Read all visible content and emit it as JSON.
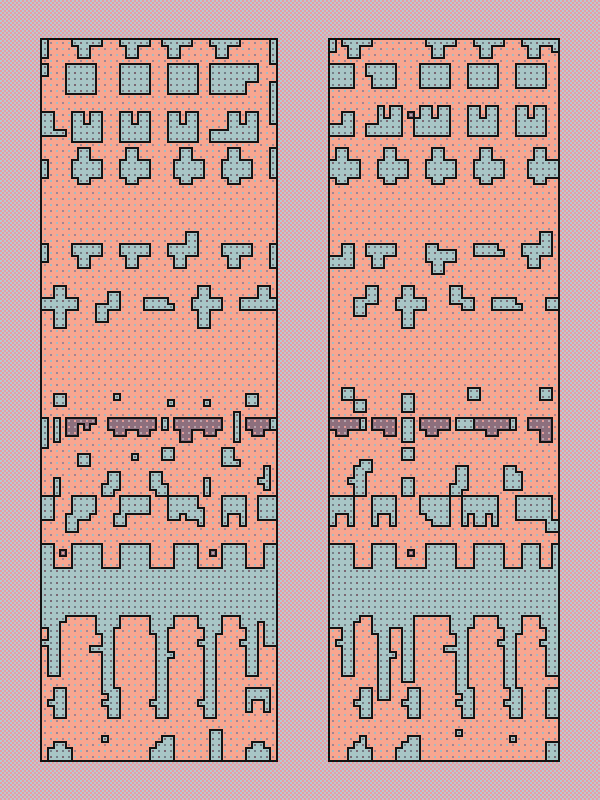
{
  "scene": {
    "width": 600,
    "height": 800
  },
  "background": {
    "checker_colors": [
      "#eb9aa3",
      "#b6cbd1"
    ],
    "checker_px": 2
  },
  "palette": {
    "salmon": "#f8a690",
    "blue": "#a8c6c6",
    "mauve": "#8d6f7d",
    "outline": "#141414",
    "dot_on_salmon": [
      "#a2bcc4",
      "#a08693"
    ],
    "dot_on_blue": [
      "#7b6773",
      "#748089"
    ],
    "dot_on_mauve": [
      "#e49c98",
      "#b5a3ad"
    ]
  },
  "grid": {
    "cell_px": 6,
    "rows": 120,
    "border_px": 2,
    "dot_px": 2,
    "dot_offset": 2
  },
  "shapes": {
    "tab": [
      "bbbbb",
      ".bb..",
      ".bb.."
    ],
    "tabF": [
      "bbbbb",
      "bbbbb",
      ".bb..",
      ".bb.."
    ],
    "tabFlag": [
      "...bb",
      "...bb",
      "bbbbb",
      "bbbbb",
      ".bb..",
      ".bb.."
    ],
    "tabFlagL": [
      "bb...",
      "bbbbb",
      "bbbbb",
      ".bb..",
      ".bb.."
    ],
    "flagL": [
      "..bb",
      "..bb",
      "bbbb",
      "bbbb"
    ],
    "rect55": [
      "bbbbb",
      "bbbbb",
      "bbbbb",
      "bbbbb",
      "bbbbb"
    ],
    "rectNotch": [
      "bbbbbbbb",
      "bbbbbbbb",
      "bbbbbbbb",
      "bbbbbb..",
      "bbbbbb.."
    ],
    "rectNBL": [
      "bbbbb",
      "bbbbb",
      ".bbbb",
      ".bbbb"
    ],
    "rectNBLtall": [
      "bbbbb",
      "bbbbb",
      "bbbbb",
      ".bbbb",
      "..bbb"
    ],
    "cup": [
      "bb.bb",
      "bb.bb",
      "bbbbb",
      "bbbbb",
      "bbbbb"
    ],
    "cupFoot": [
      "...bb.bb",
      "...bb.bb",
      "...bbbbb",
      "bbbbbbbb",
      "bbbbbbbb"
    ],
    "cupFootL": [
      "..b.bb",
      "..b.bb",
      "..bbbb",
      "bbbbbb",
      "bbbbbb"
    ],
    "edgeL": [
      "bb..",
      "bb..",
      "bb..",
      "bbbb"
    ],
    "cross": [
      ".bb..",
      ".bb..",
      "bbbbb",
      "bbbbb",
      "bbbbb",
      ".bb.."
    ],
    "plusTall": [
      ".bb..",
      ".bb..",
      "bbbbb",
      "bbbbb",
      ".bb..",
      ".bb..",
      ".bb.."
    ],
    "hook4": [
      "..bb",
      "..bb",
      "bbbb",
      "bb..",
      "bb.."
    ],
    "hook4R": [
      "bb..",
      "bb..",
      "bbbb",
      "..bb"
    ],
    "barStep": [
      "bbbb.",
      "bbbbb"
    ],
    "barFlagR": [
      "...bb",
      "...bb",
      "bbbbb",
      "bbbbb"
    ],
    "bootL4": [
      ".bb",
      ".bb",
      "bbb",
      "bb."
    ],
    "bootR4": [
      "bb.",
      "bb.",
      "bbb",
      ".bb"
    ],
    "boot3": [
      "bb.",
      "bb.",
      "bbb"
    ],
    "tleft": [
      ".b",
      ".b",
      "bb",
      ".b"
    ],
    "blobH": [
      ".bbbb",
      ".bbbb",
      ".bbbb",
      "bbbb.",
      "bb...",
      "bb..."
    ],
    "blobM": [
      "bbbbb",
      "bbbbb",
      "bbbbb",
      "bb.bb"
    ],
    "arch": [
      "bbbb",
      "bbbb",
      "bbbb",
      "b..b",
      "b..b"
    ],
    "arch4": [
      "bbbb",
      "bbbb",
      "b..b",
      "b..b"
    ],
    "arch2": [
      "bbbbbb",
      "bbbbbb",
      "bbbbbb",
      "b.bb.b",
      "b.bb.b"
    ],
    "midA": [
      ".bb",
      ".bb",
      "bbb",
      ".bb",
      ".bb"
    ],
    "dripB": [
      "bbbb",
      "bbb.",
      ".bb.",
      ".bb.",
      "bbb.",
      ".bb.",
      ".bb.",
      ".bb.",
      ".bb.",
      ".bb."
    ],
    "dripC": [
      ".bbbb",
      ".bbbb",
      ".bbb.",
      "..bb.",
      "..bb.",
      "bbbb.",
      "..bb.",
      "..bb.",
      "..bb.",
      "..bb.",
      "..bb.",
      "..bb.",
      "..bb."
    ],
    "dripD": [
      "bbbb",
      "bbbb",
      "bbb.",
      ".bb.",
      ".bb.",
      ".bb.",
      ".bbb",
      ".bb.",
      ".bb.",
      ".bb.",
      ".bb.",
      ".bb.",
      ".bb.",
      ".bb."
    ],
    "dripE": [
      "bbbb",
      "bbbb",
      ".bbb",
      ".bb.",
      "bbb.",
      ".bb.",
      ".bb.",
      ".bb.",
      ".bb.",
      ".bb.",
      ".bb.",
      ".bb."
    ],
    "bot": [
      ".bb.",
      "bbbb",
      "bbbb"
    ],
    "botTall": [
      "..bb",
      ".bbb",
      "bbbb",
      "bbbb"
    ],
    "mA": [
      "ppppp",
      "pp.p.",
      "pp..."
    ],
    "mtable": [
      "pppppppp",
      "pppppppp",
      ".pp..pp."
    ],
    "mtableB": [
      "pppppppp",
      "pppppppp",
      ".pp..pp.",
      ".pp....."
    ],
    "mtableR": [
      "pppp",
      "pppp",
      ".pp."
    ],
    "m5": [
      "ppppp",
      "ppppp",
      ".pp.."
    ],
    "mt4": [
      "pppp",
      "pppp",
      "..pp"
    ],
    "mt4L": [
      "pppp",
      "pppp",
      "..pp",
      "..pp"
    ],
    "mLong": [
      "pppppp",
      "pppppp",
      "..pp.."
    ],
    "msq": [
      "p"
    ],
    "sq1": [
      "b"
    ],
    "sq2": [
      "bb",
      "bb"
    ]
  },
  "panels": [
    {
      "name": "left-pattern-panel",
      "x": 40,
      "y": 38,
      "cols": 39,
      "placements": [
        [
          "#",
          0,
          0,
          1,
          3,
          "b"
        ],
        [
          "tab",
          5,
          0
        ],
        [
          "tab",
          13,
          0
        ],
        [
          "tab",
          20,
          0
        ],
        [
          "tab",
          28,
          0
        ],
        [
          "#",
          38,
          0,
          1,
          4,
          "b"
        ],
        [
          "#",
          0,
          4,
          1,
          2,
          "b"
        ],
        [
          "rect55",
          4,
          4
        ],
        [
          "rect55",
          13,
          4
        ],
        [
          "rect55",
          21,
          4
        ],
        [
          "rectNotch",
          28,
          4
        ],
        [
          "#",
          38,
          7,
          1,
          4,
          "b"
        ],
        [
          "edgeL",
          0,
          12
        ],
        [
          "cup",
          5,
          12
        ],
        [
          "cup",
          13,
          12
        ],
        [
          "cup",
          21,
          12
        ],
        [
          "cupFoot",
          28,
          12
        ],
        [
          "#",
          38,
          11,
          1,
          3,
          "b"
        ],
        [
          "#",
          0,
          20,
          1,
          3,
          "b"
        ],
        [
          "cross",
          5,
          18
        ],
        [
          "cross",
          13,
          18
        ],
        [
          "cross",
          22,
          18
        ],
        [
          "cross",
          30,
          18
        ],
        [
          "#",
          38,
          18,
          1,
          5,
          "b"
        ],
        [
          "#",
          0,
          34,
          1,
          3,
          "b"
        ],
        [
          "tabF",
          5,
          34
        ],
        [
          "tabF",
          13,
          34
        ],
        [
          "tabFlag",
          21,
          32
        ],
        [
          "tabF",
          30,
          34
        ],
        [
          "#",
          38,
          34,
          1,
          4,
          "b"
        ],
        [
          "plusTall",
          1,
          41
        ],
        [
          "#",
          0,
          43,
          1,
          2,
          "b"
        ],
        [
          "hook4",
          9,
          42
        ],
        [
          "barStep",
          17,
          43
        ],
        [
          "plusTall",
          25,
          41
        ],
        [
          "barFlagR",
          33,
          41
        ],
        [
          "#",
          38,
          43,
          1,
          2,
          "b"
        ],
        [
          "sq2",
          2,
          59
        ],
        [
          "sq1",
          12,
          59
        ],
        [
          "sq1",
          21,
          60
        ],
        [
          "sq1",
          27,
          60
        ],
        [
          "sq2",
          34,
          59
        ],
        [
          "#",
          0,
          63,
          1,
          5,
          "b"
        ],
        [
          "#",
          2,
          63,
          1,
          4,
          "b"
        ],
        [
          "mA",
          4,
          63
        ],
        [
          "mtable",
          11,
          63
        ],
        [
          "#",
          20,
          63,
          1,
          2,
          "b"
        ],
        [
          "mtableB",
          22,
          63
        ],
        [
          "#",
          32,
          62,
          1,
          5,
          "b"
        ],
        [
          "mtableR",
          34,
          63
        ],
        [
          "#",
          38,
          63,
          1,
          2,
          "b"
        ],
        [
          "sq2",
          6,
          69
        ],
        [
          "sq1",
          15,
          69
        ],
        [
          "sq2",
          20,
          68
        ],
        [
          "boot3",
          30,
          68
        ],
        [
          "#",
          2,
          73,
          1,
          3,
          "b"
        ],
        [
          "bootL4",
          10,
          72
        ],
        [
          "bootR4",
          18,
          72
        ],
        [
          "#",
          27,
          73,
          1,
          3,
          "b"
        ],
        [
          "tleft",
          36,
          71
        ],
        [
          "#",
          0,
          76,
          2,
          4,
          "b"
        ],
        [
          "blobH",
          4,
          76
        ],
        [
          "sq2",
          12,
          79
        ],
        [
          "#",
          13,
          76,
          5,
          3,
          "b"
        ],
        [
          "blobM",
          21,
          76
        ],
        [
          "#",
          26,
          78,
          1,
          3,
          "b"
        ],
        [
          "arch",
          30,
          76
        ],
        [
          "#",
          36,
          76,
          3,
          4,
          "b"
        ],
        [
          "#",
          0,
          84,
          2,
          4,
          "b"
        ],
        [
          "msq",
          3,
          85
        ],
        [
          "#",
          5,
          84,
          5,
          4,
          "b"
        ],
        [
          "#",
          13,
          84,
          5,
          4,
          "b"
        ],
        [
          "#",
          22,
          84,
          4,
          4,
          "b"
        ],
        [
          "msq",
          28,
          85
        ],
        [
          "#",
          30,
          84,
          4,
          4,
          "b"
        ],
        [
          "#",
          37,
          84,
          2,
          4,
          "b"
        ],
        [
          "#",
          0,
          88,
          39,
          8,
          "b"
        ],
        [
          "dripB",
          0,
          96
        ],
        [
          "dripC",
          8,
          96
        ],
        [
          "dripD",
          18,
          96
        ],
        [
          "dripE",
          26,
          96
        ],
        [
          "dripB",
          33,
          96
        ],
        [
          "#",
          37,
          96,
          2,
          5,
          "b"
        ],
        [
          "midA",
          1,
          108
        ],
        [
          "midA",
          10,
          108
        ],
        [
          "midA",
          18,
          108
        ],
        [
          "midA",
          26,
          108
        ],
        [
          "arch4",
          34,
          108
        ],
        [
          "sq1",
          10,
          116
        ],
        [
          "sq1",
          20,
          116
        ],
        [
          "#",
          28,
          115,
          2,
          5,
          "b"
        ],
        [
          "bot",
          1,
          117
        ],
        [
          "botTall",
          18,
          116
        ],
        [
          "bot",
          34,
          117
        ]
      ]
    },
    {
      "name": "right-pattern-panel",
      "x": 328,
      "y": 38,
      "cols": 38,
      "placements": [
        [
          "#",
          0,
          0,
          1,
          2,
          "b"
        ],
        [
          "tab",
          2,
          0
        ],
        [
          "tab",
          16,
          0
        ],
        [
          "tab",
          24,
          0
        ],
        [
          "tab",
          32,
          0
        ],
        [
          "#",
          37,
          0,
          1,
          2,
          "b"
        ],
        [
          "#",
          0,
          4,
          4,
          4,
          "b"
        ],
        [
          "rectNBL",
          6,
          4
        ],
        [
          "#",
          15,
          4,
          5,
          4,
          "b"
        ],
        [
          "#",
          23,
          4,
          5,
          4,
          "b"
        ],
        [
          "#",
          31,
          4,
          5,
          4,
          "b"
        ],
        [
          "flagL",
          0,
          12
        ],
        [
          "cupFootL",
          6,
          11
        ],
        [
          "msq",
          13,
          12
        ],
        [
          "#",
          14,
          13,
          1,
          3,
          "b"
        ],
        [
          "cup",
          15,
          11
        ],
        [
          "cup",
          23,
          11
        ],
        [
          "cup",
          31,
          11
        ],
        [
          "cross",
          0,
          18
        ],
        [
          "cross",
          8,
          18
        ],
        [
          "cross",
          16,
          18
        ],
        [
          "cross",
          24,
          18
        ],
        [
          "cross",
          33,
          18
        ],
        [
          "flagL",
          0,
          34
        ],
        [
          "tabF",
          6,
          34
        ],
        [
          "tabFlagL",
          16,
          34
        ],
        [
          "barStep",
          24,
          34
        ],
        [
          "tabFlag",
          32,
          32
        ],
        [
          "hook4",
          4,
          41
        ],
        [
          "plusTall",
          11,
          41
        ],
        [
          "hook4R",
          20,
          41
        ],
        [
          "barStep",
          27,
          43
        ],
        [
          "#",
          36,
          43,
          2,
          2,
          "b"
        ],
        [
          "sq2",
          2,
          58
        ],
        [
          "sq2",
          4,
          60
        ],
        [
          "#",
          12,
          59,
          2,
          3,
          "b"
        ],
        [
          "sq2",
          23,
          58
        ],
        [
          "sq2",
          35,
          58
        ],
        [
          "m5",
          0,
          63
        ],
        [
          "#",
          5,
          63,
          1,
          2,
          "b"
        ],
        [
          "mt4",
          7,
          63
        ],
        [
          "#",
          12,
          63,
          2,
          4,
          "b"
        ],
        [
          "m5",
          15,
          63
        ],
        [
          "#",
          21,
          63,
          3,
          2,
          "b"
        ],
        [
          "mLong",
          24,
          63
        ],
        [
          "#",
          30,
          63,
          1,
          2,
          "b"
        ],
        [
          "mt4L",
          33,
          63
        ],
        [
          "sq2",
          12,
          68
        ],
        [
          "#",
          5,
          70,
          2,
          2,
          "b"
        ],
        [
          "#",
          21,
          71,
          2,
          1,
          "b"
        ],
        [
          "#",
          29,
          71,
          2,
          1,
          "b"
        ],
        [
          "midA",
          3,
          71
        ],
        [
          "#",
          12,
          73,
          2,
          3,
          "b"
        ],
        [
          "bootL4",
          20,
          72
        ],
        [
          "#",
          29,
          72,
          3,
          3,
          "b"
        ],
        [
          "arch",
          0,
          76
        ],
        [
          "#",
          3,
          79,
          1,
          2,
          "b"
        ],
        [
          "arch",
          7,
          76
        ],
        [
          "rectNBLtall",
          15,
          76
        ],
        [
          "arch2",
          22,
          76
        ],
        [
          "#",
          31,
          76,
          6,
          4,
          "b"
        ],
        [
          "#",
          36,
          80,
          2,
          2,
          "b"
        ],
        [
          "#",
          0,
          84,
          4,
          4,
          "b"
        ],
        [
          "#",
          7,
          84,
          4,
          4,
          "b"
        ],
        [
          "msq",
          13,
          85
        ],
        [
          "#",
          16,
          84,
          5,
          4,
          "b"
        ],
        [
          "#",
          24,
          84,
          5,
          4,
          "b"
        ],
        [
          "#",
          32,
          84,
          3,
          4,
          "b"
        ],
        [
          "#",
          37,
          84,
          1,
          4,
          "b"
        ],
        [
          "#",
          0,
          88,
          38,
          8,
          "b"
        ],
        [
          "#",
          0,
          96,
          1,
          2,
          "b"
        ],
        [
          "dripB",
          1,
          96
        ],
        [
          "dripD",
          7,
          96
        ],
        [
          "#",
          10,
          96,
          4,
          2,
          "b"
        ],
        [
          "#",
          12,
          98,
          2,
          9,
          "b"
        ],
        [
          "dripC",
          19,
          96
        ],
        [
          "dripE",
          28,
          96
        ],
        [
          "dripB",
          35,
          96
        ],
        [
          "#",
          37,
          96,
          1,
          7,
          "b"
        ],
        [
          "midA",
          4,
          108
        ],
        [
          "midA",
          12,
          108
        ],
        [
          "midA",
          21,
          108
        ],
        [
          "midA",
          29,
          108
        ],
        [
          "#",
          36,
          108,
          2,
          5,
          "b"
        ],
        [
          "sq1",
          5,
          116
        ],
        [
          "sq1",
          21,
          115
        ],
        [
          "sq1",
          30,
          116
        ],
        [
          "bot",
          3,
          117
        ],
        [
          "botTall",
          11,
          116
        ],
        [
          "#",
          36,
          117,
          2,
          3,
          "b"
        ]
      ]
    }
  ]
}
